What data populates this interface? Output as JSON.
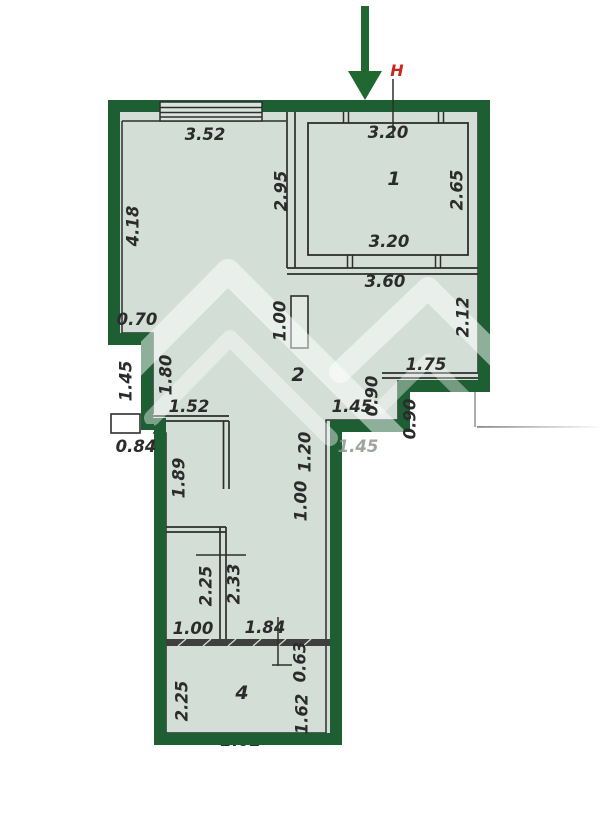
{
  "colors": {
    "wall_green": "#1d5e33",
    "arrow_green": "#20682f",
    "floor_fill": "#d2ded6",
    "marker_red": "#c9271d",
    "line_dark": "#2e2e2e"
  },
  "entrance": {
    "marker": "Н"
  },
  "rooms": [
    {
      "number": "1"
    },
    {
      "number": "2"
    },
    {
      "number": "4"
    }
  ],
  "dimensions": [
    {
      "value": "3.52"
    },
    {
      "value": "3.20"
    },
    {
      "value": "2.95"
    },
    {
      "value": "2.65"
    },
    {
      "value": "4.18"
    },
    {
      "value": "3.20"
    },
    {
      "value": "3.60"
    },
    {
      "value": "2.12"
    },
    {
      "value": "0.70"
    },
    {
      "value": "1.00"
    },
    {
      "value": "1.75"
    },
    {
      "value": "1.45"
    },
    {
      "value": "1.80"
    },
    {
      "value": "0.90"
    },
    {
      "value": "0.90"
    },
    {
      "value": "1.52"
    },
    {
      "value": "1.45"
    },
    {
      "value": "1.45"
    },
    {
      "value": "0.84"
    },
    {
      "value": "1.89"
    },
    {
      "value": "1.20"
    },
    {
      "value": "1.00"
    },
    {
      "value": "2.25"
    },
    {
      "value": "2.33"
    },
    {
      "value": "1.00"
    },
    {
      "value": "1.84"
    },
    {
      "value": "0.63"
    },
    {
      "value": "2.25"
    },
    {
      "value": "1.62"
    },
    {
      "value": "2.02"
    }
  ]
}
